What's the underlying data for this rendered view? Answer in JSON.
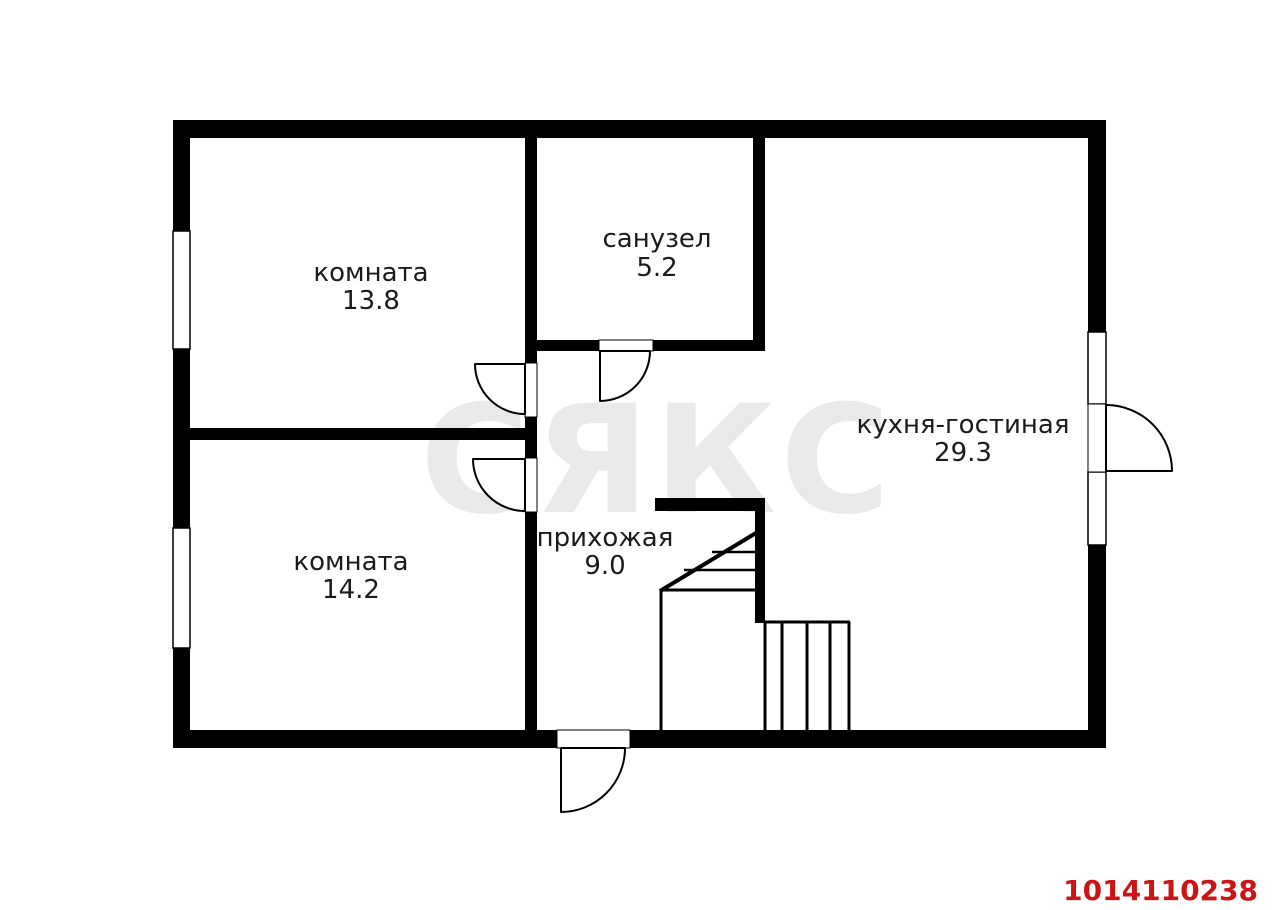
{
  "plan": {
    "rooms": [
      {
        "name": "комната",
        "area": "13.8"
      },
      {
        "name": "санузел",
        "area": "5.2"
      },
      {
        "name": "кухня-гостиная",
        "area": "29.3"
      },
      {
        "name": "комната",
        "area": "14.2"
      },
      {
        "name": "прихожая",
        "area": "9.0"
      }
    ],
    "watermark": "СЯКС",
    "listing_id": "1014110238",
    "colors": {
      "wall": "#000000",
      "text": "#1b1b1b",
      "watermark": "#e9e9e9",
      "listing_id": "#cc1414",
      "background": "#ffffff"
    }
  }
}
